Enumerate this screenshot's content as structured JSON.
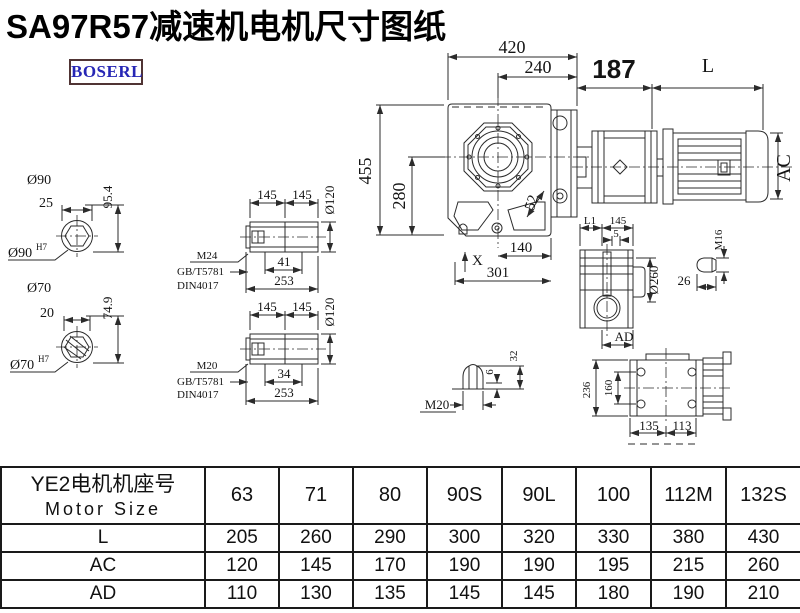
{
  "page": {
    "title": "SA97R57减速机电机尺寸图纸",
    "logo_text": "BOSERL"
  },
  "colors": {
    "line": "#2b2b2b",
    "text": "#141414",
    "logo_text": "#2626b5",
    "logo_border": "#503434"
  },
  "front_view": {
    "overall_width": "420",
    "hub_offset": "240",
    "adapter_length": "187",
    "motor_length": "L",
    "overall_height": "455",
    "center_height": "280",
    "oblique_dim": "52",
    "foot_hole_offset": "140",
    "base_length": "301",
    "x_mark": "X",
    "motor_diameter": "AC"
  },
  "shaft_end_views": {
    "upper": {
      "od_label": "Ø90",
      "key_width": "25",
      "height": "95.4",
      "bore_label": "Ø90",
      "bore_tolerance": "H7"
    },
    "lower": {
      "od_label": "Ø70",
      "key_width": "20",
      "height": "74.9",
      "bore_label": "Ø70",
      "bore_tolerance": "H7"
    }
  },
  "hollow_shaft_views": {
    "upper": {
      "seg1": "145",
      "seg2": "145",
      "od": "Ø120",
      "step": "41",
      "total": "253",
      "thread": "M24",
      "standard1": "GB/T5781",
      "standard2": "DIN4017"
    },
    "lower": {
      "seg1": "145",
      "seg2": "145",
      "od": "Ø120",
      "step": "34",
      "total": "253",
      "thread": "M20",
      "standard1": "GB/T5781",
      "standard2": "DIN4017"
    }
  },
  "side_view": {
    "l1": "L1",
    "width": "145",
    "gap": "5",
    "flange_od": "Ø260",
    "ad": "AD"
  },
  "bolt_detail": {
    "thread": "M16",
    "length": "26"
  },
  "plug_detail": {
    "thread": "M20",
    "height": "6",
    "length": "32"
  },
  "bottom_view": {
    "height": "236",
    "bolt_spacing": "160",
    "w1": "135",
    "w2": "113"
  },
  "table": {
    "header_cn": "YE2电机机座号",
    "header_en": "Motor Size",
    "sizes": [
      "63",
      "71",
      "80",
      "90S",
      "90L",
      "100",
      "112M",
      "132S"
    ],
    "rows": [
      {
        "label": "L",
        "values": [
          "205",
          "260",
          "290",
          "300",
          "320",
          "330",
          "380",
          "430"
        ]
      },
      {
        "label": "AC",
        "values": [
          "120",
          "145",
          "170",
          "190",
          "190",
          "195",
          "215",
          "260"
        ]
      },
      {
        "label": "AD",
        "values": [
          "110",
          "130",
          "135",
          "145",
          "145",
          "180",
          "190",
          "210"
        ]
      }
    ]
  }
}
